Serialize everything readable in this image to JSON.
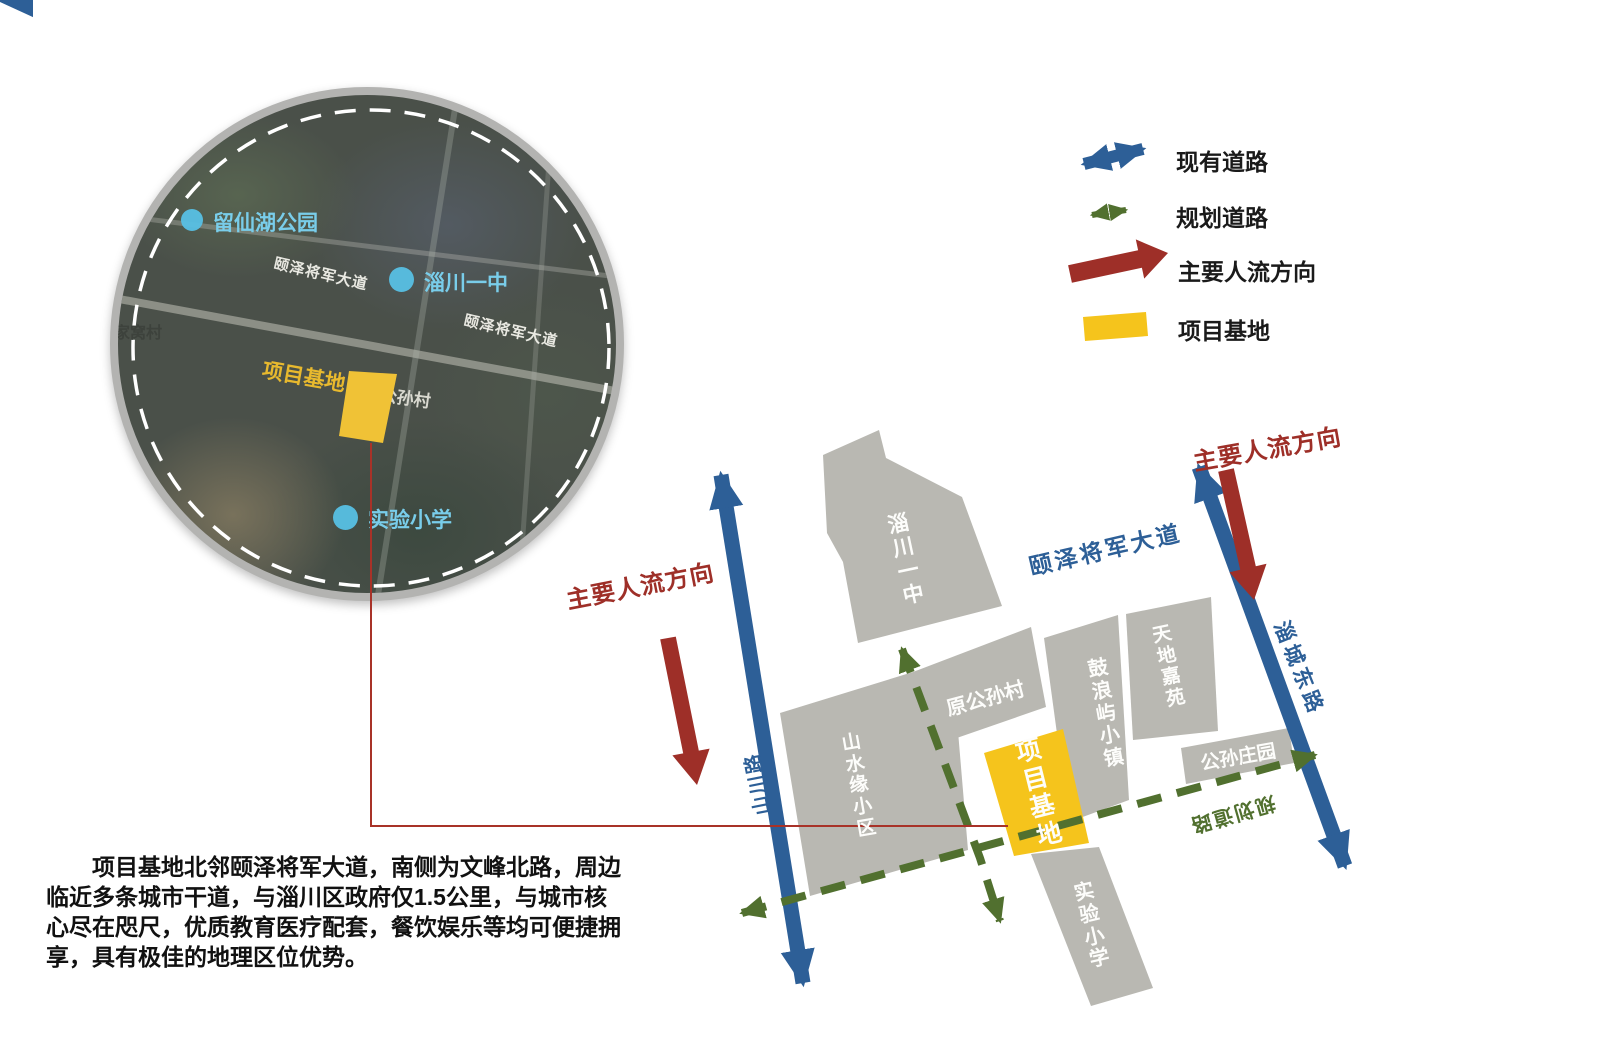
{
  "legend": {
    "items": [
      {
        "label": "现有道路",
        "icon": "double-arrow-blue",
        "color": "#2d5f97"
      },
      {
        "label": "规划道路",
        "icon": "dashed-arrow-green",
        "color": "#51702f"
      },
      {
        "label": "主要人流方向",
        "icon": "thick-arrow-red",
        "color": "#9e2f28"
      },
      {
        "label": "项目基地",
        "icon": "yellow-swatch",
        "color": "#f5c41c"
      }
    ]
  },
  "satellite": {
    "labels": {
      "park": "留仙湖公园",
      "school_mid": "淄川一中",
      "road_a": "颐泽将军大道",
      "road_b": "颐泽将军大道",
      "village_west": "家窝村",
      "site": "项目基地",
      "village": "公孙村",
      "school_south": "实验小学"
    }
  },
  "map": {
    "road_main": "颐泽将军大道",
    "road_east": "淄城东路",
    "road_west": "山川路",
    "road_planned": "规划道路",
    "flow_left": "主要人流方向",
    "flow_right": "主要人流方向",
    "site": "项目基地",
    "blocks": {
      "b1": "淄川一中",
      "b2": "原公孙村",
      "b3": "鼓浪屿小镇",
      "b4": "天地嘉苑",
      "b5": "公孙庄园",
      "b6": "山水缘小区",
      "b7": "实验小学"
    }
  },
  "description": {
    "lines": [
      "　　项目基地北邻颐泽将军大道，南侧为文峰北路，周边",
      "临近多条城市干道，与淄川区政府仅1.5公里，与城市核",
      "心尽在咫尺，优质教育医疗配套，餐饮娱乐等均可便捷拥",
      "享，具有极佳的地理区位优势。"
    ]
  },
  "colors": {
    "road_blue": "#2d5f97",
    "planned_green": "#51702f",
    "flow_red": "#9e2f28",
    "site_yellow": "#f5c41c",
    "block_gray": "#b9b8b2",
    "poi_cyan": "#57c0e4",
    "sat_label_blue": "#79cdea",
    "sat_site_yellow": "#e8b92e"
  }
}
